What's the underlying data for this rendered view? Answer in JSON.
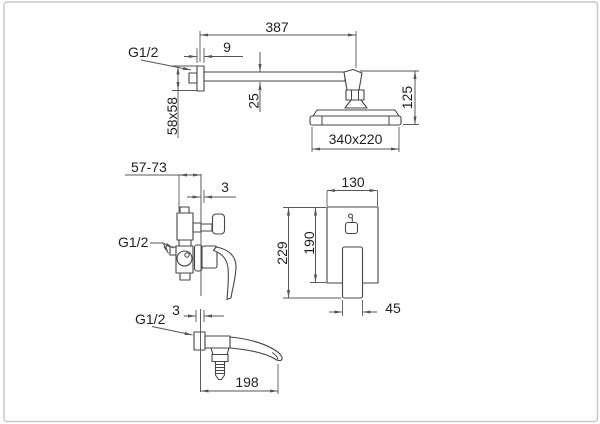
{
  "colors": {
    "background": "#ffffff",
    "frame": "#c7c7c7",
    "part_line": "#454545",
    "dimension_line": "#555555",
    "text": "#1f1f1f"
  },
  "views": {
    "shower": {
      "arm_length": "387",
      "thread": "G1/2",
      "flange_thickness": "9",
      "arm_profile_height": "25",
      "flange_size": "58x58",
      "drop_height": "125",
      "head_size": "340x220"
    },
    "mixer_side": {
      "mount_depth_range": "57-73",
      "wall_offset": "3",
      "thread": "G1/2"
    },
    "mixer_front": {
      "plate_width": "130",
      "plate_height": "190",
      "overall_height": "229",
      "handle_width": "45"
    },
    "spout": {
      "wall_offset": "3",
      "thread": "G1/2",
      "length": "198"
    }
  }
}
